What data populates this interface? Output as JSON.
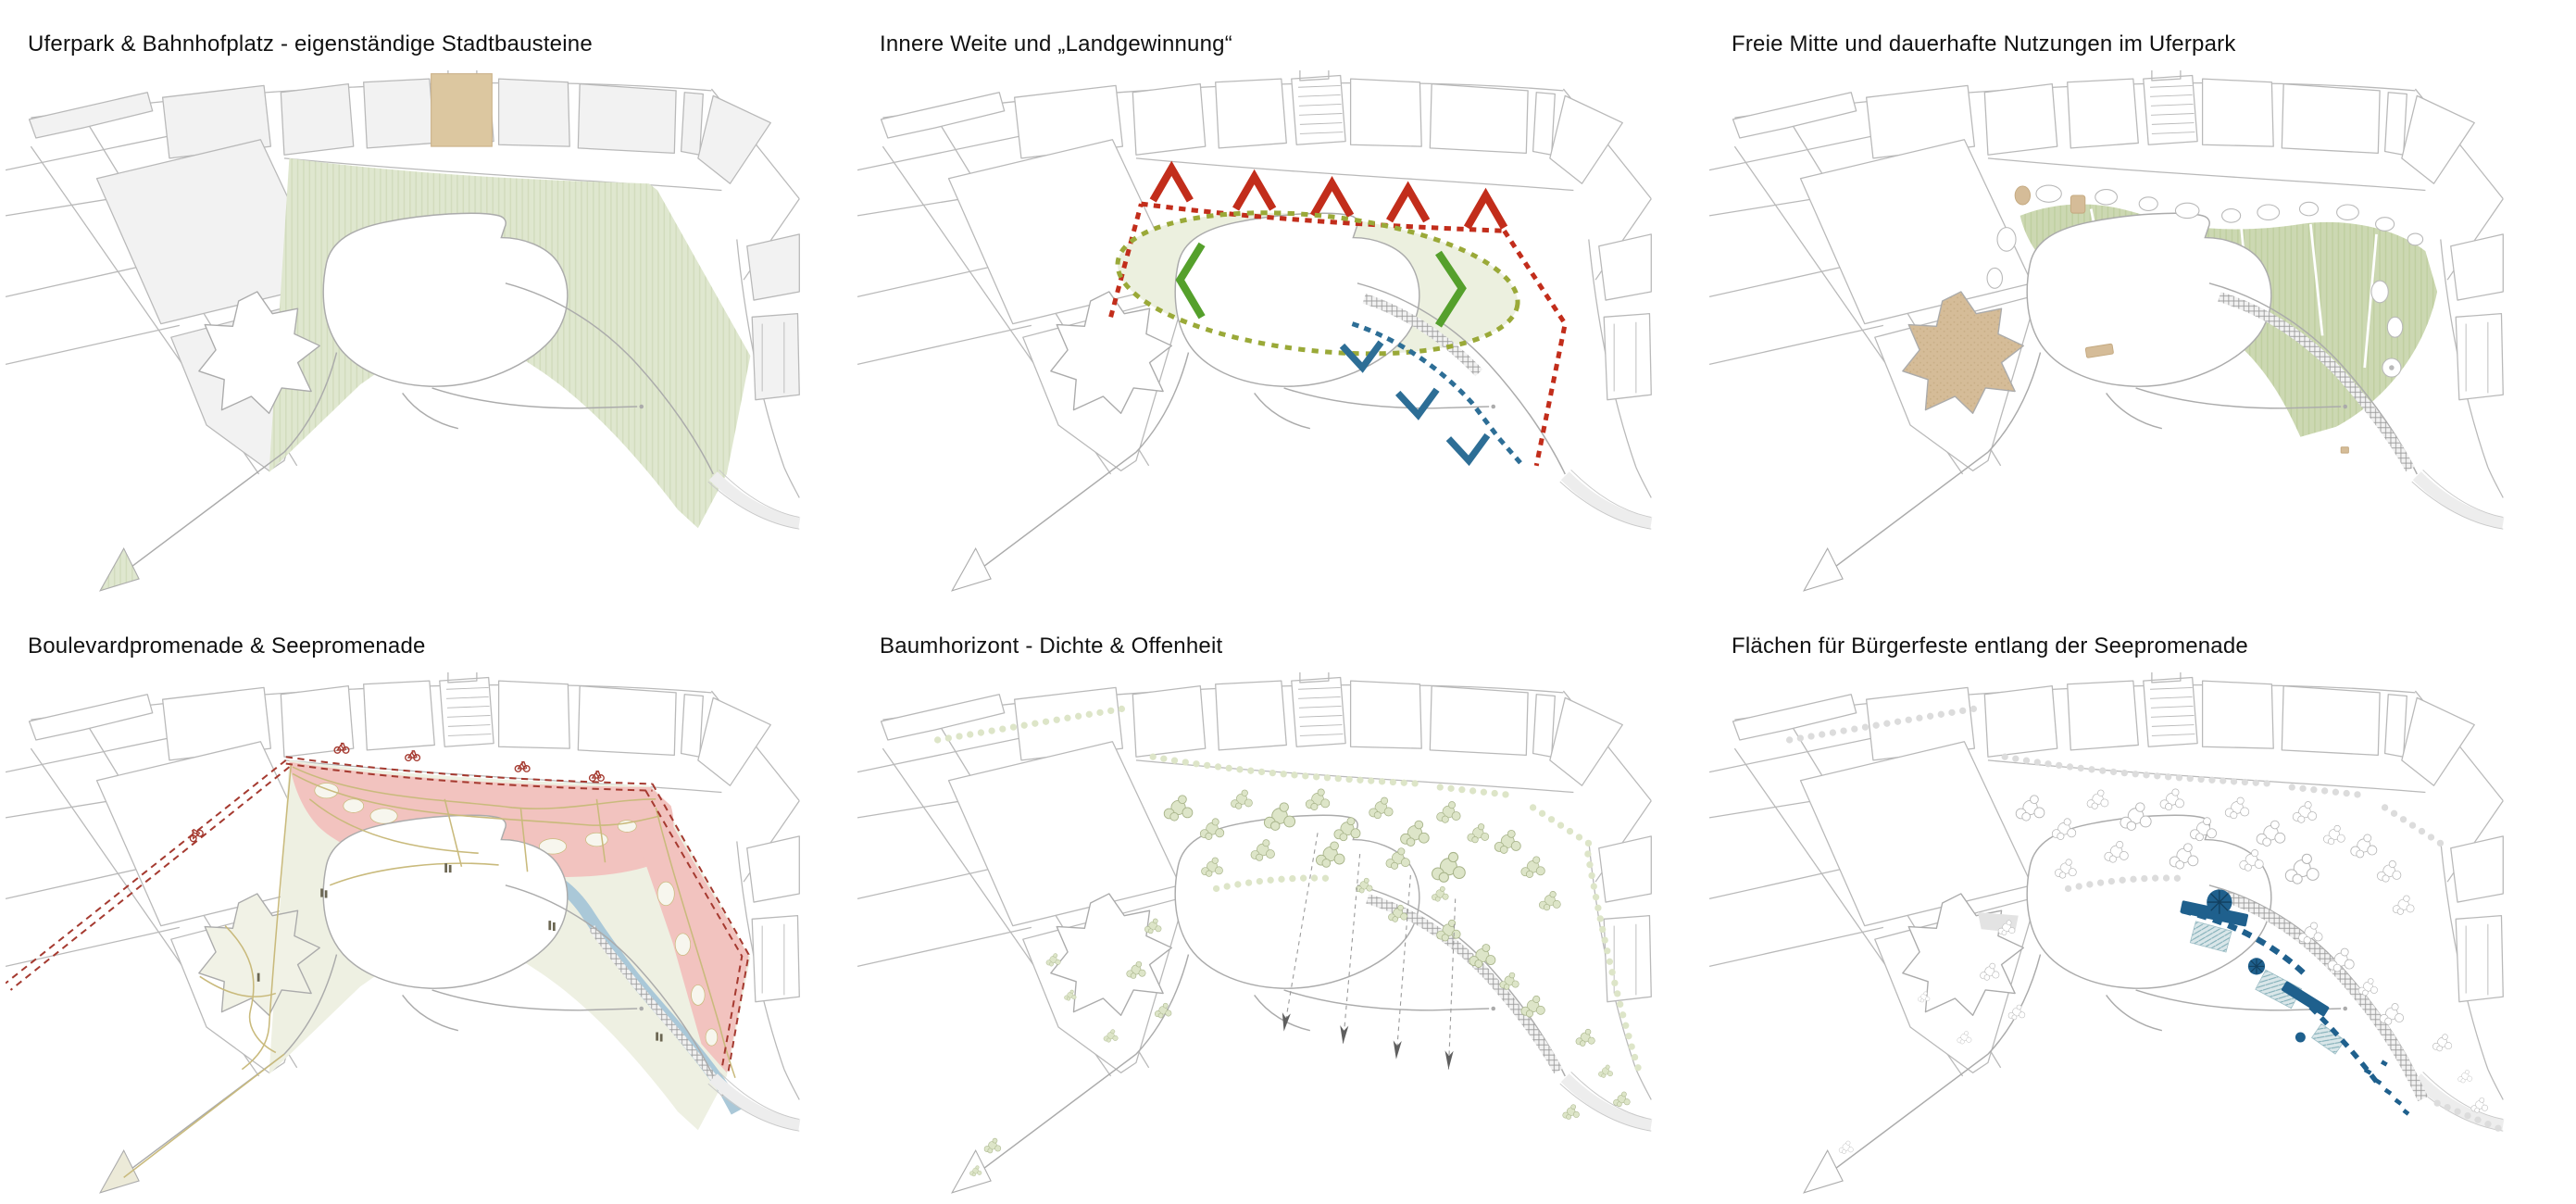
{
  "page": {
    "background": "#ffffff"
  },
  "panels": [
    {
      "id": "uferpark-bahnhofplatz",
      "title": "Uferpark & Bahnhofplatz - eigenständige Stadtbausteine"
    },
    {
      "id": "innere-weite",
      "title": "Innere Weite und „Landgewinnung“"
    },
    {
      "id": "freie-mitte",
      "title": "Freie Mitte und dauerhafte Nutzungen im Uferpark"
    },
    {
      "id": "boulevardpromenade",
      "title": "Boulevardpromenade & Seepromenade"
    },
    {
      "id": "baumhorizont",
      "title": "Baumhorizont - Dichte & Offenheit"
    },
    {
      "id": "buergerfeste",
      "title": "Flächen für Bürgerfeste entlang der Seepromenade"
    }
  ],
  "palette": {
    "title": "#111111",
    "base_gray": "#b9b9b9",
    "block_gray": "#f2f2f2",
    "park_green": "#dfe7cf",
    "park_green_line": "#d2dcbd",
    "park_pale": "#eef0e2",
    "band_green": "#ccd8b2",
    "band_green_line": "#bfcfa0",
    "square_tan": "#dcc7a0",
    "star_tan": "#d5bc98",
    "star_tan_dot": "#c7ad85",
    "boundary_red": "#c22d1b",
    "route_red": "#a53a30",
    "chevron_green": "#55a02c",
    "ellipse_olive": "#9aa938",
    "ellipse_fill": "#ecf0df",
    "promenade_blue": "#2d6e96",
    "festival_blue": "#1f608d",
    "water_blue": "#aac8d8",
    "promenade_pink": "#f2c3bf",
    "pink_hole": "#f7f6ee",
    "path_khaki": "#c9ba7c",
    "tree_green": "#dde5c8",
    "tree_green_line": "#a7b389",
    "hatch_gray": "#9b9b9b",
    "teal_fill": "#d9e6e9",
    "teal_line": "#7fadb6",
    "figure_dark": "#6b6652"
  }
}
